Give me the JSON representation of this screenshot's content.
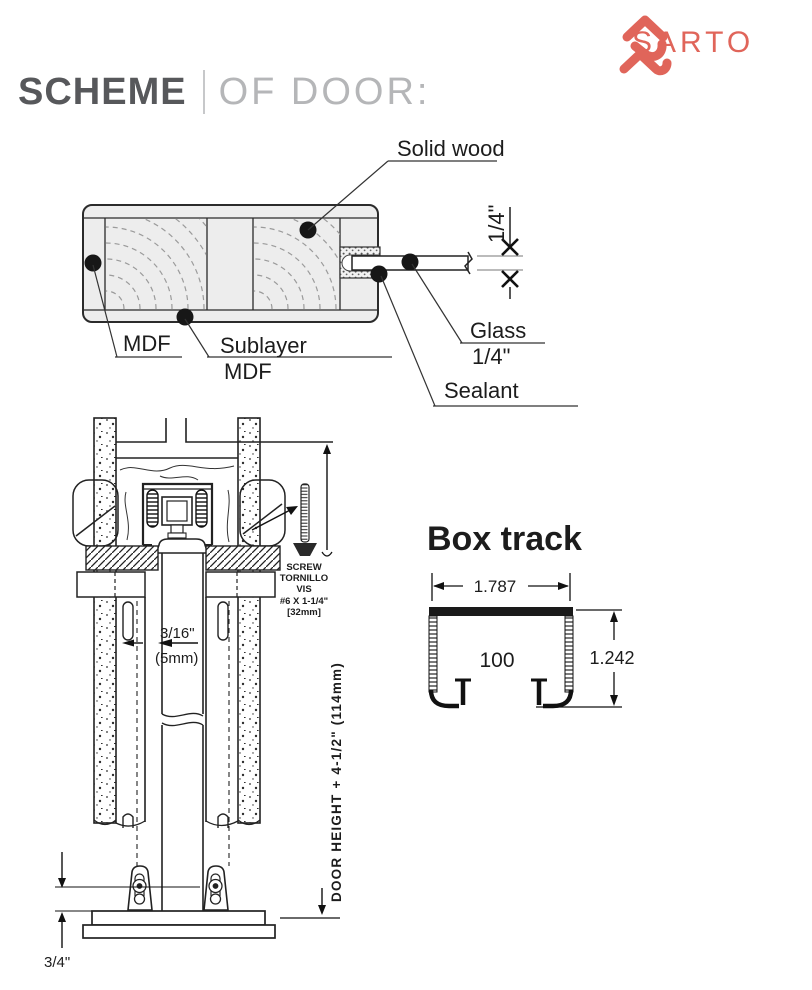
{
  "header": {
    "title_primary": "SCHEME",
    "title_secondary": "OF DOOR:",
    "brand": "SARTO"
  },
  "colors": {
    "accent": "#e0655a",
    "title_dark": "#57585b",
    "title_light": "#b5b6b8",
    "ink": "#1c1c1c"
  },
  "door_section": {
    "labels": {
      "solid_wood": "Solid wood",
      "mdf": "MDF",
      "sublayer_line1": "Sublayer",
      "sublayer_line2": "MDF",
      "glass_line1": "Glass",
      "glass_line2": "1/4\"",
      "sealant": "Sealant",
      "thickness": "1/4\""
    }
  },
  "mechanism": {
    "gap_line1": "3/16\"",
    "gap_line2": "(5mm)",
    "screw": {
      "l1": "SCREW",
      "l2": "TORNILLO",
      "l3": "VIS",
      "l4": "#6 X 1-1/4\"",
      "l5": "[32mm]"
    },
    "height_label": "DOOR HEIGHT + 4-1/2\" (114mm)",
    "floor_clearance": "3/4\""
  },
  "box_track": {
    "title": "Box track",
    "width": "1.787",
    "model": "100",
    "height": "1.242"
  }
}
